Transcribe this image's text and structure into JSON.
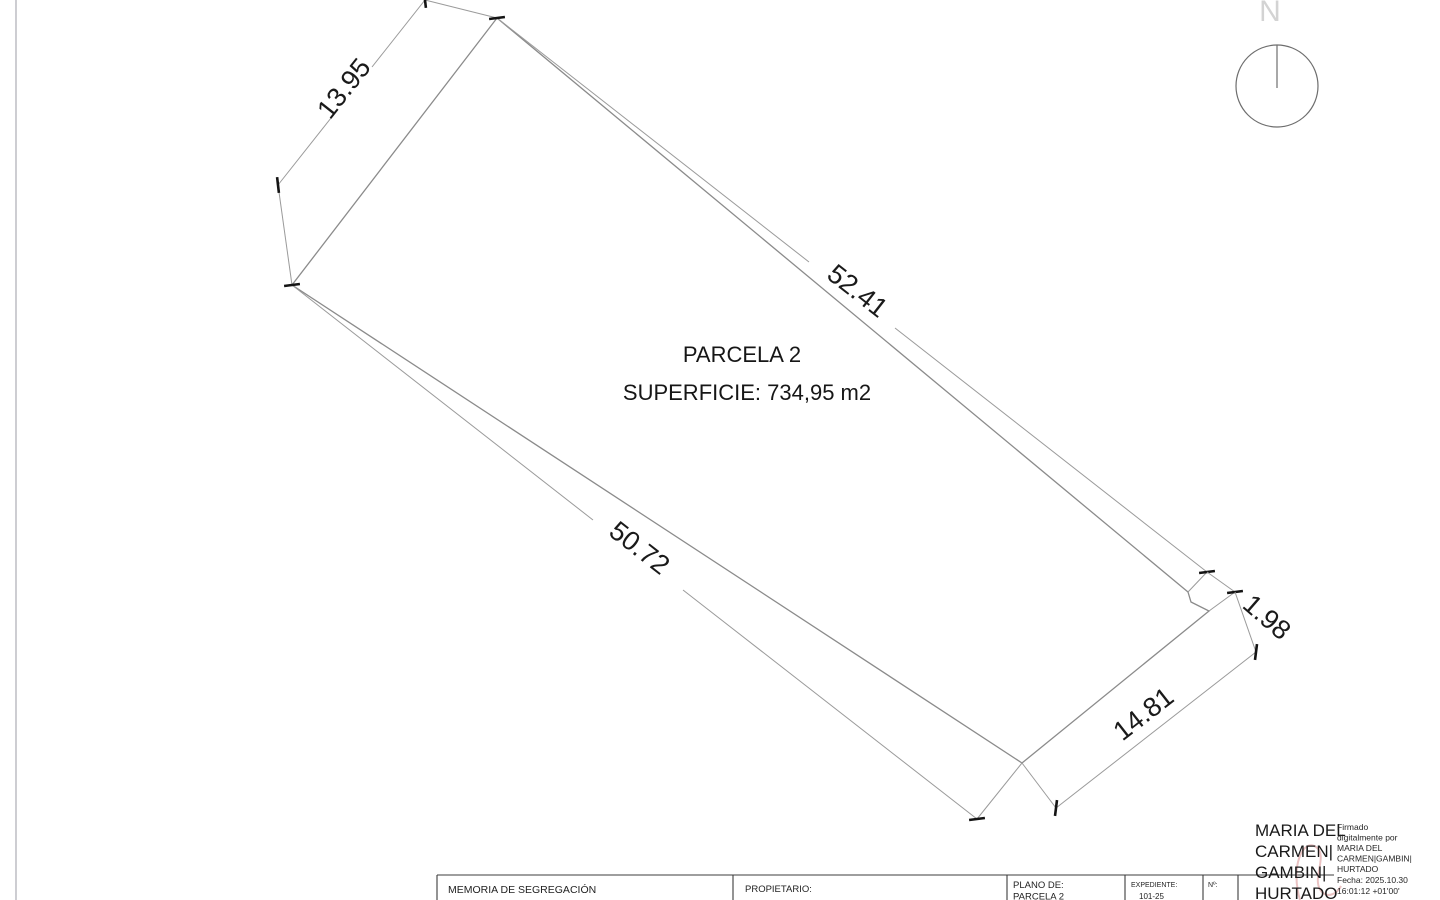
{
  "drawing": {
    "parcel": {
      "name": "PARCELA 2",
      "area": "SUPERFICIE: 734,95 m2"
    },
    "dimensions": [
      {
        "value": "13.95"
      },
      {
        "value": "52.41"
      },
      {
        "value": "50.72"
      },
      {
        "value": "1.98"
      },
      {
        "value": "14.81"
      }
    ],
    "north_label": "N"
  },
  "title_block": {
    "document_title": "MEMORIA DE SEGREGACIÓN",
    "owner_label": "PROPIETARIO:",
    "plan_label": "PLANO DE:",
    "plan_value": "PARCELA 2",
    "file_label": "EXPEDIENTE:",
    "file_value": "101-25",
    "number_label": "Nº:"
  },
  "signature": {
    "name_lines": [
      "MARIA DEL",
      "CARMEN|",
      "GAMBIN|",
      "HURTADO"
    ],
    "detail_lines": [
      "Firmado",
      "digitalmente por",
      "MARIA DEL",
      "CARMEN|GAMBIN|",
      "HURTADO",
      "Fecha: 2025.10.30",
      "16:01:12 +01'00'"
    ]
  },
  "colors": {
    "line_gray": "#8b8b8b",
    "text_dark": "#1a1a1a",
    "north_gray": "#d3d3d3",
    "signature_accent": "#dfa3a3"
  }
}
